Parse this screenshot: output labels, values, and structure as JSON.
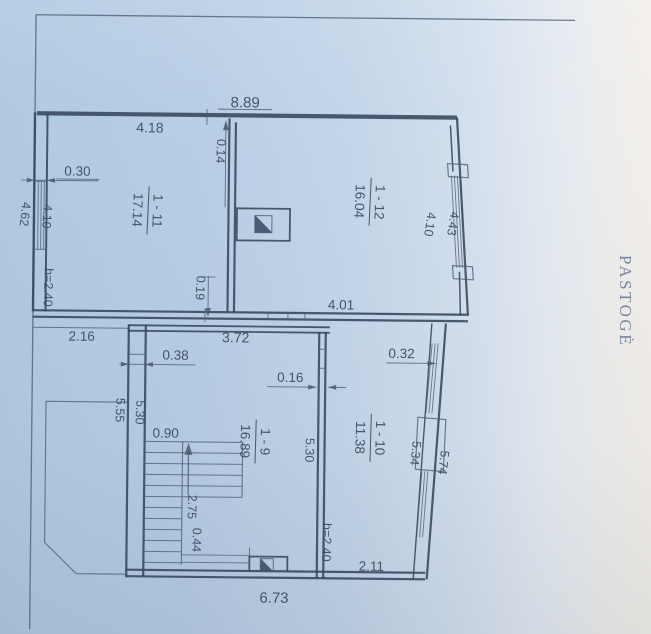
{
  "page": {
    "side_label": "PASTOGĖ"
  },
  "rooms": {
    "r1_11": {
      "name": "1 - 11",
      "area": "17.14"
    },
    "r1_12": {
      "name": "1 - 12",
      "area": "16.04"
    },
    "r1_9": {
      "name": "1 - 9",
      "area": "16.89"
    },
    "r1_10": {
      "name": "1 - 10",
      "area": "11.38"
    }
  },
  "dimensions": {
    "top_total": "8.89",
    "top_left_segment": "4.18",
    "top_wall_jog": "0.14",
    "left_wall_thickness": "0.30",
    "left_side_outer": "4.62",
    "left_side_inner": "4.10",
    "upper_room_height": "h=2.40",
    "right_side_inner_upper": "4.10",
    "right_side_outer_upper": "4.43",
    "mid_wall_jog": "0.19",
    "mid_right_segment": "4.01",
    "mid_opening": "3.72",
    "mid_left_segment": "2.16",
    "pier_width": "0.38",
    "right_wall_thickness": "0.32",
    "partition_thickness": "0.16",
    "lower_left_outer": "5.55",
    "lower_left_inner": "5.30",
    "stair_flight_width": "0.90",
    "lower_mid_inner": "5.30",
    "right_side_inner_lower": "5.34",
    "right_side_outer_lower": "5.74",
    "stair_run": "2.75",
    "stair_landing": "0.44",
    "lower_room_height": "h=2.40",
    "bottom_right_segment": "2.11",
    "bottom_total": "6.73"
  },
  "colors": {
    "paper_left": "#b0c9e1",
    "paper_right": "#f4f0e9",
    "ink": "#3a4b5d",
    "wall": "#36475c"
  }
}
